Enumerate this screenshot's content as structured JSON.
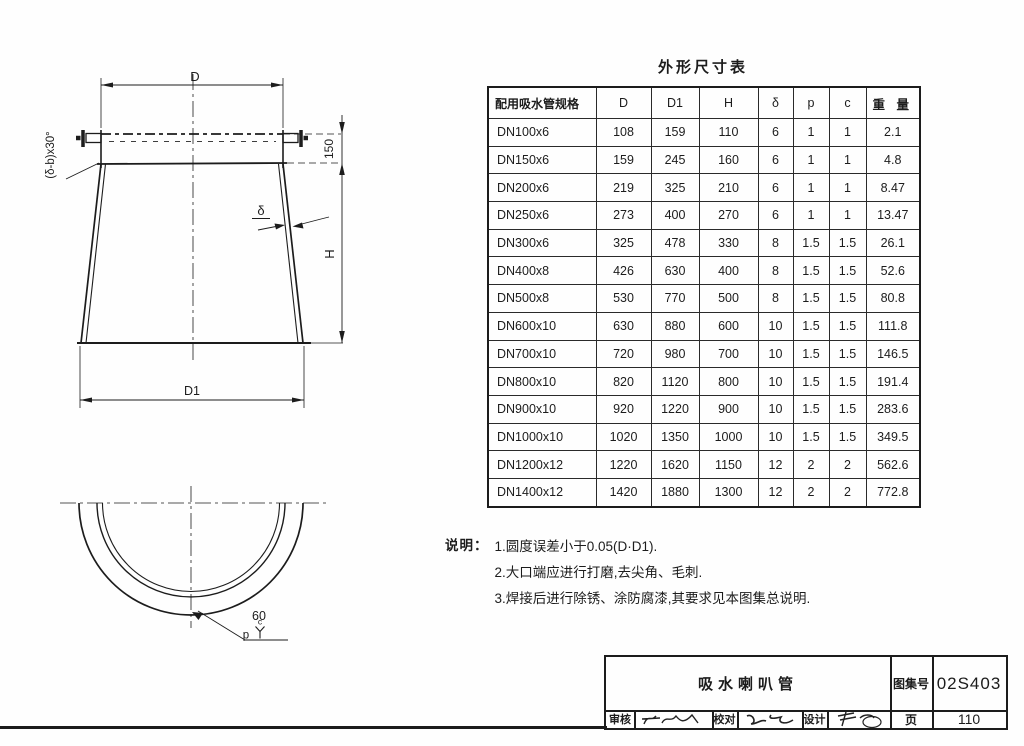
{
  "page_bg": "#fefefe",
  "ink": "#1c1c1c",
  "drawing": {
    "front_view": {
      "top_dia_label": "D",
      "bottom_dia_label": "D1",
      "height_label": "H",
      "rim_height_label": "150",
      "thickness_label": "δ",
      "chamfer_label": "(δ-b)x30°"
    },
    "plan_view": {
      "bevel_angle_label": "60",
      "gap_label": "p",
      "root_face_label": "c"
    }
  },
  "table": {
    "title": "外形尺寸表",
    "columns": [
      "配用吸水管规格",
      "D",
      "D1",
      "H",
      "δ",
      "p",
      "c",
      "重 量"
    ],
    "rows": [
      [
        "DN100x6",
        "108",
        "159",
        "110",
        "6",
        "1",
        "1",
        "2.1"
      ],
      [
        "DN150x6",
        "159",
        "245",
        "160",
        "6",
        "1",
        "1",
        "4.8"
      ],
      [
        "DN200x6",
        "219",
        "325",
        "210",
        "6",
        "1",
        "1",
        "8.47"
      ],
      [
        "DN250x6",
        "273",
        "400",
        "270",
        "6",
        "1",
        "1",
        "13.47"
      ],
      [
        "DN300x6",
        "325",
        "478",
        "330",
        "8",
        "1.5",
        "1.5",
        "26.1"
      ],
      [
        "DN400x8",
        "426",
        "630",
        "400",
        "8",
        "1.5",
        "1.5",
        "52.6"
      ],
      [
        "DN500x8",
        "530",
        "770",
        "500",
        "8",
        "1.5",
        "1.5",
        "80.8"
      ],
      [
        "DN600x10",
        "630",
        "880",
        "600",
        "10",
        "1.5",
        "1.5",
        "111.8"
      ],
      [
        "DN700x10",
        "720",
        "980",
        "700",
        "10",
        "1.5",
        "1.5",
        "146.5"
      ],
      [
        "DN800x10",
        "820",
        "1120",
        "800",
        "10",
        "1.5",
        "1.5",
        "191.4"
      ],
      [
        "DN900x10",
        "920",
        "1220",
        "900",
        "10",
        "1.5",
        "1.5",
        "283.6"
      ],
      [
        "DN1000x10",
        "1020",
        "1350",
        "1000",
        "10",
        "1.5",
        "1.5",
        "349.5"
      ],
      [
        "DN1200x12",
        "1220",
        "1620",
        "1150",
        "12",
        "2",
        "2",
        "562.6"
      ],
      [
        "DN1400x12",
        "1420",
        "1880",
        "1300",
        "12",
        "2",
        "2",
        "772.8"
      ]
    ]
  },
  "notes": {
    "label": "说明：",
    "items": [
      "1.圆度误差小于0.05(D·D1).",
      "2.大口端应进行打磨,去尖角、毛刺.",
      "3.焊接后进行除锈、涂防腐漆,其要求见本图集总说明."
    ]
  },
  "titleblock": {
    "title": "吸水喇叭管",
    "atlas_label": "图集号",
    "atlas_no": "02S403",
    "page_label": "页",
    "page_no": "110",
    "review_label": "审核",
    "check_label": "校对",
    "design_label": "设计"
  }
}
